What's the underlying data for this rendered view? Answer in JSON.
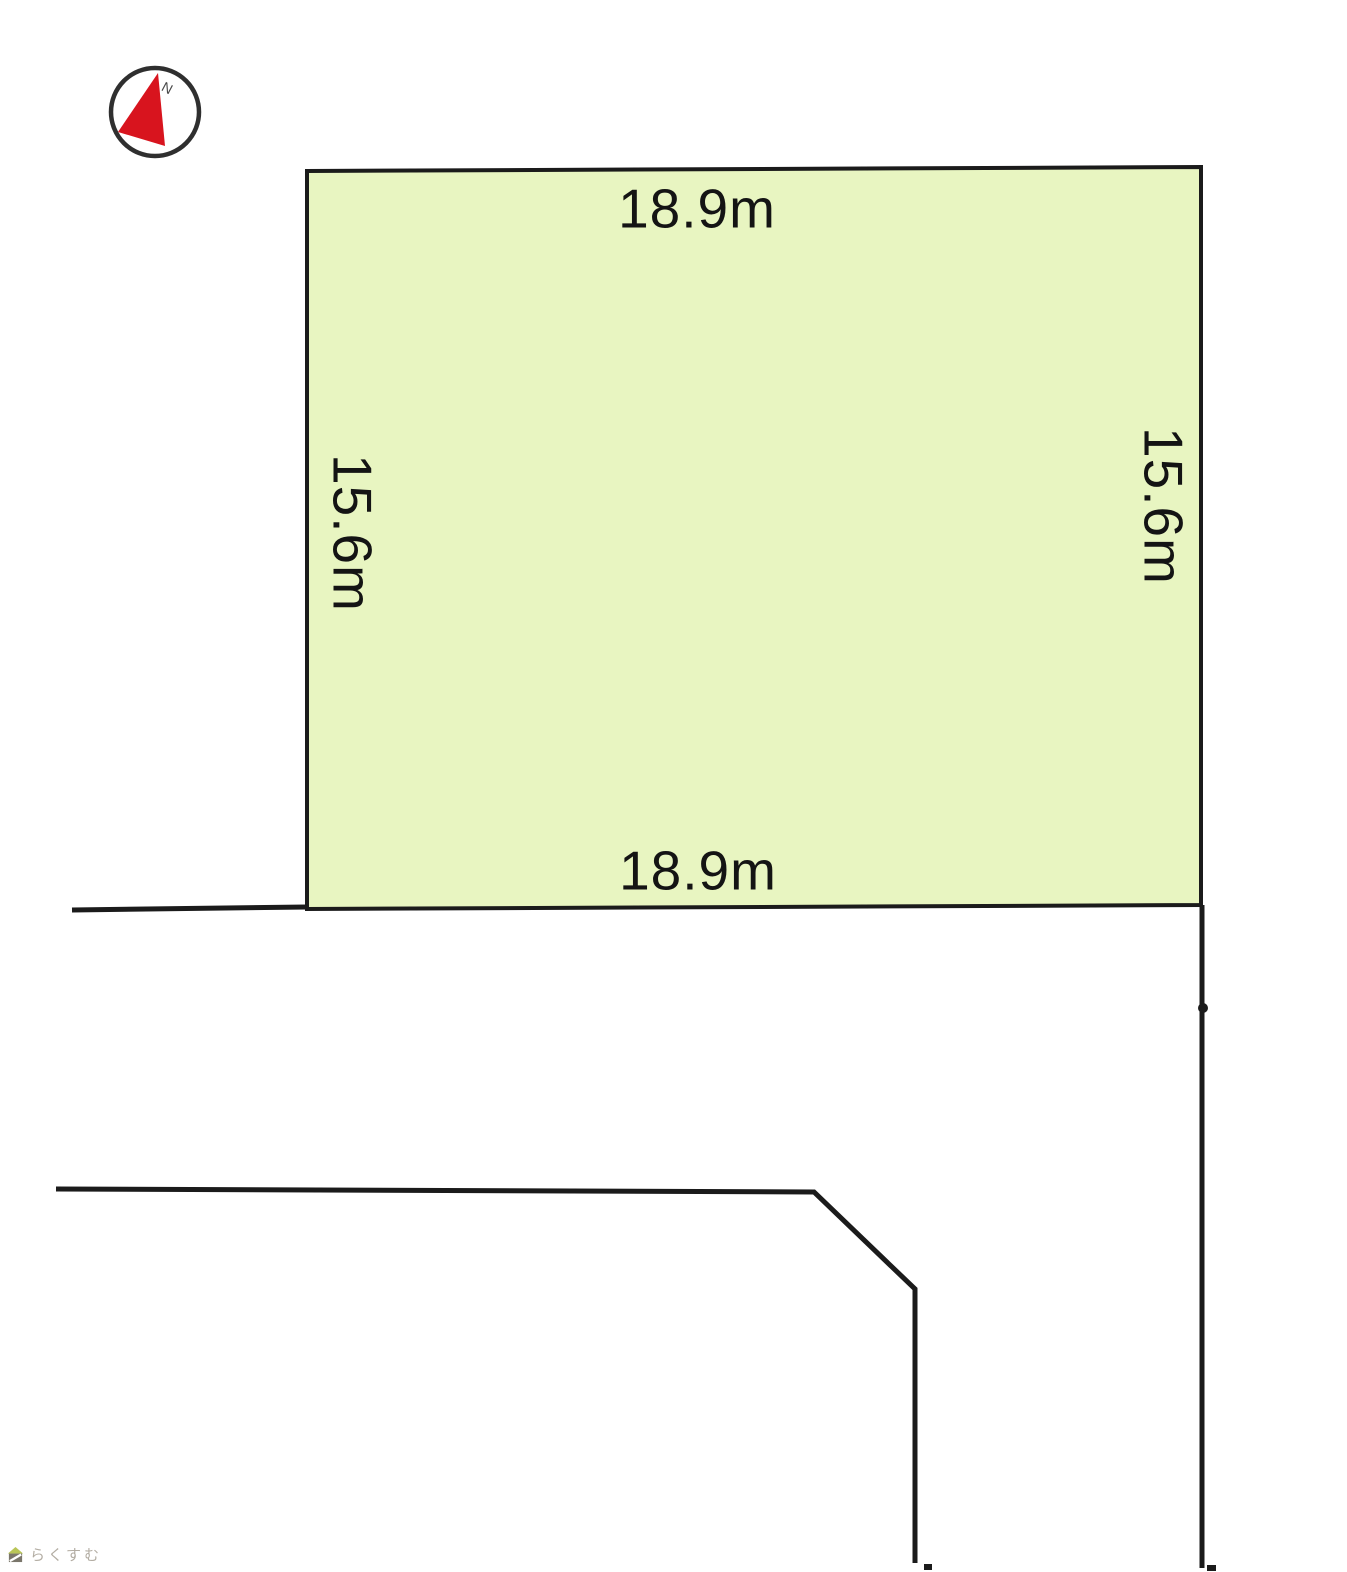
{
  "diagram": {
    "type": "land-plot-layout",
    "plot": {
      "fill_color": "#e8f5c1",
      "outline_color": "#1b1b1b",
      "dim_top": "18.9m",
      "dim_bottom": "18.9m",
      "dim_left": "15.6m",
      "dim_right": "15.6m"
    },
    "compass": {
      "north_label": "N",
      "arrow_color": "#d8141e",
      "ring_color": "#2f2f2f"
    },
    "roads": {
      "line_color": "#1b1b1b"
    }
  },
  "watermark": {
    "brand": "らくすむ",
    "text_color": "#b3ada3",
    "roof_color": "#b9c557",
    "body_color": "#7a766b"
  }
}
